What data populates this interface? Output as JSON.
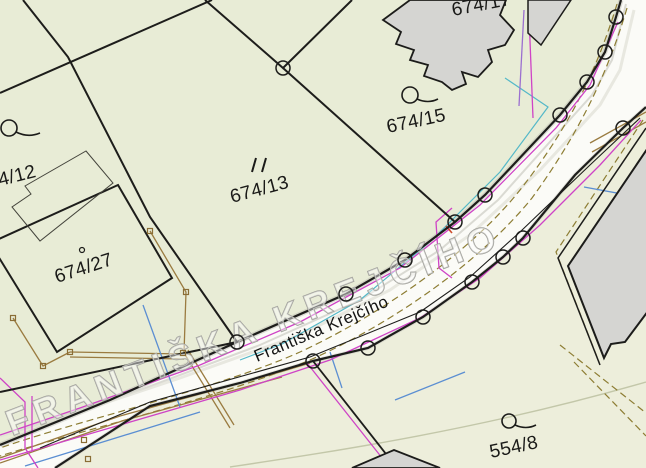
{
  "map": {
    "title": "cadastral-map-view",
    "street": {
      "name": "Františka Krejčího",
      "name_caps": "FRANTIŠKA KREJČÍHO"
    },
    "parcels": [
      {
        "label": "4/12"
      },
      {
        "label": "674/13"
      },
      {
        "label": "674/15"
      },
      {
        "label": "674/17"
      },
      {
        "label": "674/27"
      },
      {
        "label": "554/8"
      }
    ],
    "symbols": [
      {
        "name": "circle-flag-landuse-symbol",
        "count": 3
      },
      {
        "name": "double-tick-landuse-symbol",
        "count": 1
      },
      {
        "name": "building-center-dot",
        "count": 1
      },
      {
        "name": "boundary-point-circle",
        "count": 17
      },
      {
        "name": "fence-post-square",
        "count": 8
      }
    ],
    "colors": {
      "background_green": "#e8ecd6",
      "background_green_light": "#edeedb",
      "road_white": "#fbfbf7",
      "building_gray": "#d5d5d2",
      "boundary_black": "#1d1d1b",
      "utility_magenta": "#cf43c6",
      "utility_purple": "#9b6fd0",
      "utility_blue": "#5b8ed2",
      "utility_cyan": "#54b8c8",
      "fence_brown": "#9a7b40",
      "boundary_olive_dashed": "#8d7d33",
      "street_caps_gray": "#9d9d97"
    }
  }
}
